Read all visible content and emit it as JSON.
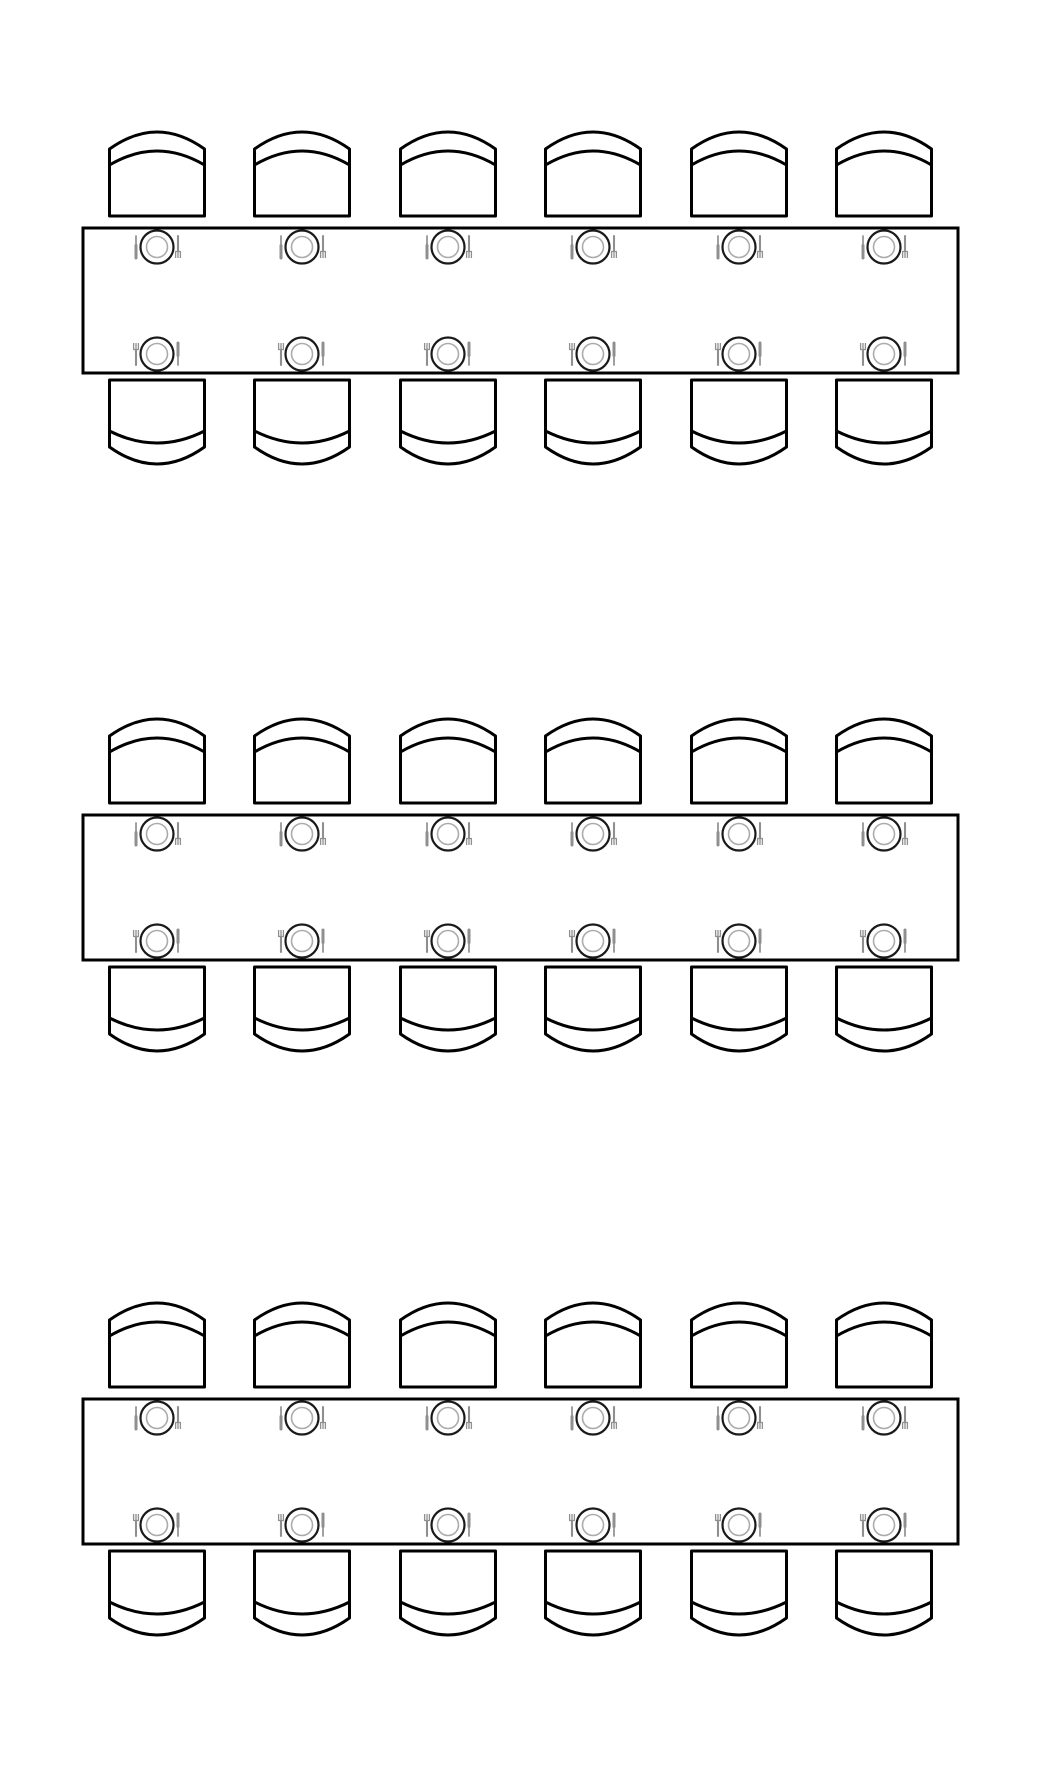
{
  "scene": {
    "type": "banquet-seating-plan",
    "description": "Top-down floor plan of three identical rectangular banquet tables, each seating 12 (6 chairs per long side) with a plate, fork and knife place setting at every seat. No text labels.",
    "background": "#ffffff",
    "canvas": {
      "width": 1040,
      "height": 1773
    }
  },
  "style": {
    "outline_color": "#000000",
    "outline_width": 3,
    "shape_fill": "#ffffff",
    "plate_outer_color": "#1a1a1a",
    "plate_outer_width": 2.2,
    "plate_inner_color": "#ababab",
    "plate_inner_width": 1.6,
    "cutlery_color": "#8f8f8f"
  },
  "geometry": {
    "table": {
      "x": 83,
      "width": 875,
      "height": 145
    },
    "table_tops_y": [
      228,
      815,
      1399
    ],
    "seat_centers_x": [
      157,
      302,
      448,
      593,
      739,
      884
    ],
    "chair": {
      "width": 95,
      "height": 84,
      "gap_above_table": 6,
      "gap_below_table": 7
    },
    "place_setting": {
      "plate_outer_r": 16.5,
      "plate_inner_r": 10.5,
      "inset_from_table_edge": 19,
      "cutlery_offset_x": 21,
      "cutlery_length": 22
    }
  },
  "tables": [
    {
      "name": "table-1",
      "seats_top": 6,
      "seats_bottom": 6,
      "capacity": 12
    },
    {
      "name": "table-2",
      "seats_top": 6,
      "seats_bottom": 6,
      "capacity": 12
    },
    {
      "name": "table-3",
      "seats_top": 6,
      "seats_bottom": 6,
      "capacity": 12
    }
  ],
  "seating_convention": {
    "top_row": {
      "left_utensil": "knife",
      "right_utensil": "fork",
      "fork_tines": "down",
      "orientation_deg": 180
    },
    "bottom_row": {
      "left_utensil": "fork",
      "right_utensil": "knife",
      "fork_tines": "up",
      "orientation_deg": 0
    }
  }
}
